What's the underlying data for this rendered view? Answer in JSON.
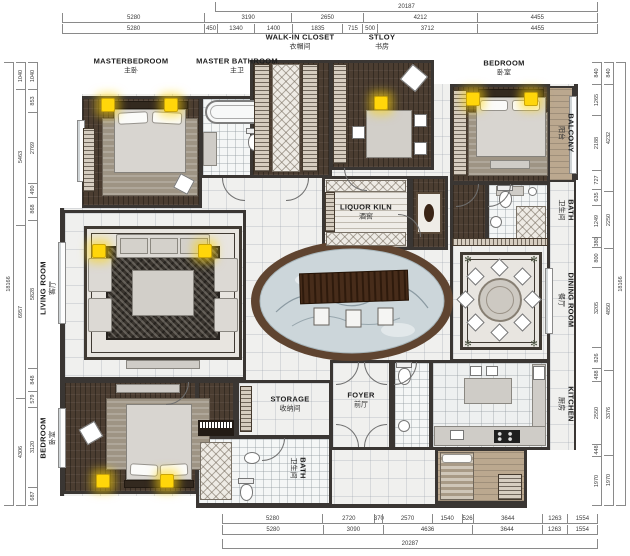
{
  "rooms": {
    "master_bedroom": {
      "en": "MASTERBEDROOM",
      "zh": "主卧"
    },
    "master_bathroom": {
      "en": "MASTER BATHROOM",
      "zh": "主卫"
    },
    "walk_in_closet": {
      "en": "WALK-IN CLOSET",
      "zh": "衣帽间"
    },
    "study": {
      "en": "STLOY",
      "zh": "书房"
    },
    "bedroom_top": {
      "en": "BEDROOM",
      "zh": "卧室"
    },
    "balcony": {
      "en": "BALCONY",
      "zh": "阳台"
    },
    "bath_right": {
      "en": "BATH",
      "zh": "卫生间"
    },
    "dining_room": {
      "en": "DINING ROOM",
      "zh": "餐厅"
    },
    "kitchen": {
      "en": "KITCHEN",
      "zh": "厨房"
    },
    "living_room": {
      "en": "LIVING ROOM",
      "zh": "客厅"
    },
    "bedroom_bottom": {
      "en": "BEDROOM",
      "zh": "卧室"
    },
    "liquor_kiln": {
      "en": "LIQUOR KILN",
      "zh": "酒窖"
    },
    "storage": {
      "en": "STORAGE",
      "zh": "收纳间"
    },
    "foyer": {
      "en": "FOYER",
      "zh": "前厅"
    },
    "bath_bottom": {
      "en": "BATH",
      "zh": "卫生间"
    }
  },
  "dimensions": {
    "top_total": "20187",
    "top_row1": [
      "5280",
      "3190",
      "2650",
      "4212",
      "4455"
    ],
    "top_row2": [
      "5280",
      "450",
      "1340",
      "1400",
      "1835",
      "715",
      "500",
      "3712",
      "4455"
    ],
    "bottom_row1": [
      "5280",
      "2720",
      "370",
      "2570",
      "1540",
      "526",
      "3644",
      "1263",
      "1554"
    ],
    "bottom_row2": [
      "5280",
      "3090",
      "4636",
      "3644",
      "1263",
      "1554"
    ],
    "bottom_total": "20287",
    "left_total": "18166",
    "left_outer": [
      "1040",
      "5463",
      "6957",
      "4306"
    ],
    "left_inner": [
      "1040",
      "853",
      "2769",
      "490",
      "868",
      "5828",
      "848",
      "579",
      "3120",
      "687"
    ],
    "right_total": "18166",
    "right_outer": [
      "840",
      "4232",
      "2250",
      "4850",
      "3376",
      "1970"
    ],
    "right_inner": [
      "840",
      "1265",
      "2188",
      "727",
      "635",
      "1249",
      "380",
      "800",
      "3205",
      "826",
      "488",
      "2550",
      "448",
      "1970"
    ]
  },
  "colors": {
    "wall": "#3a3633",
    "wood": "#4b3d31",
    "marble": "#f0f0ee",
    "tile": "#f4f6f6",
    "water": "#ccd6da",
    "pond_ring": "#5f4430",
    "bar": "#3f2818",
    "light_accent": "#ffd60a"
  }
}
